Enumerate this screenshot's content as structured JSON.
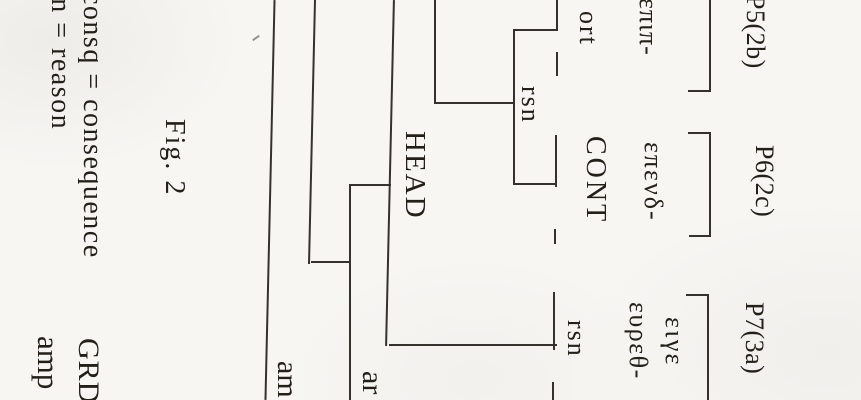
{
  "figure": {
    "caption": "Fig. 2",
    "legend": {
      "consq": "consq = consequence",
      "rsn": "rsn = reason"
    },
    "tree_labels": {
      "head": "HEAD",
      "ort": "ort",
      "rsn_upper": "rsn",
      "cont": "CONT",
      "rsn_lower": "rsn"
    },
    "edge_labels": {
      "amp_left": "amp",
      "grd": "GRD",
      "amp_mid": "am",
      "ar": "ar"
    },
    "units": [
      {
        "id": "P5(2b)",
        "greek": "επιπ-"
      },
      {
        "id": "P6(2c)",
        "greek": "επενδ-"
      },
      {
        "id": "P7(3a)",
        "greek_line1": "ειγε",
        "greek_line2": "ευρεθ-"
      }
    ],
    "tree": {
      "root": "HEAD",
      "relations": [
        {
          "label": "rsn",
          "nucleus": "ort",
          "satellite": "CONT"
        },
        {
          "label": "rsn",
          "unit": "P7(3a)"
        }
      ]
    }
  }
}
